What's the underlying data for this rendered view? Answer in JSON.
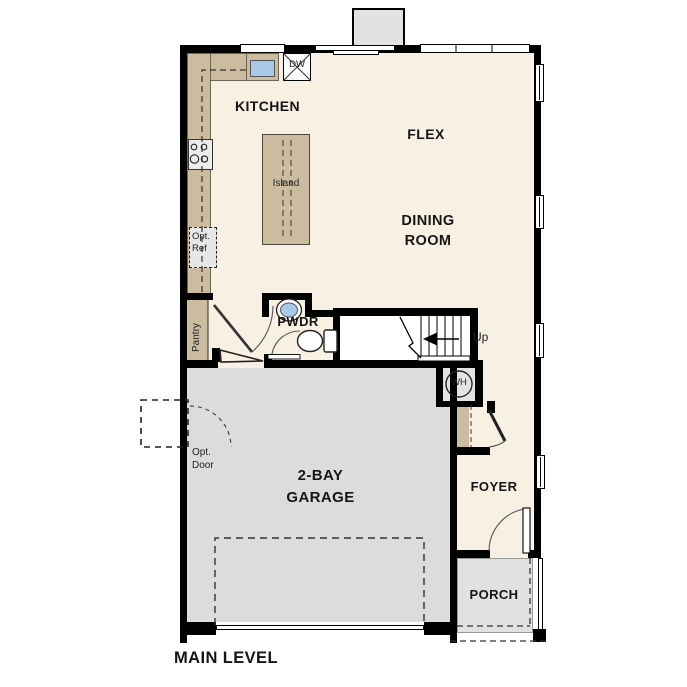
{
  "title": "MAIN LEVEL",
  "rooms": {
    "kitchen": "KITCHEN",
    "flex": "FLEX",
    "dining_room": "DINING\nROOM",
    "powder": "PWDR",
    "garage": "2-BAY\nGARAGE",
    "foyer": "FOYER",
    "porch": "PORCH"
  },
  "features": {
    "island": "Island",
    "dishwasher": "DW",
    "optional_refrigerator": "Opt.\nRef",
    "pantry": "Pantry",
    "stairs_direction": "Up",
    "water_heater": "WH",
    "optional_door": "Opt.\nDoor"
  },
  "colors": {
    "wall": "#000000",
    "interior_floor": "#f8f0e3",
    "counter_tan": "#cbbc9f",
    "garage_floor": "#dddcda",
    "porch_floor": "#e1e1df",
    "sink_blue": "#a9c9ea",
    "appliance_gray": "#ececec"
  }
}
